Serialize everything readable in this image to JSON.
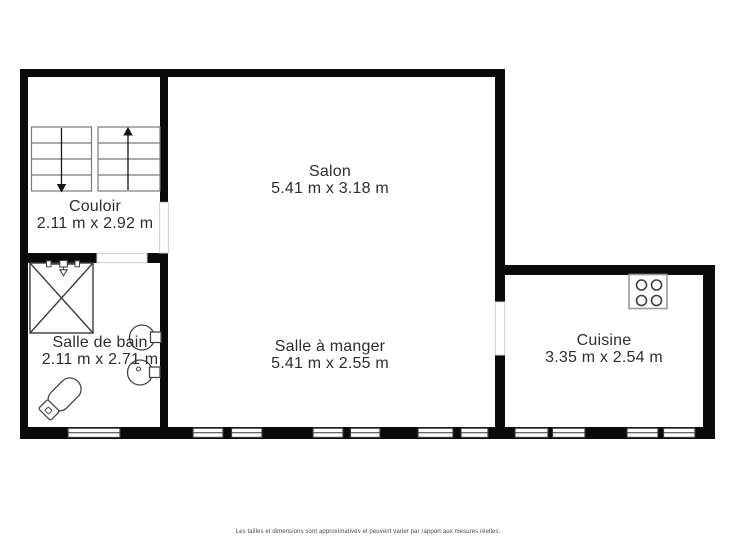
{
  "plan": {
    "title": "Floor plan",
    "rooms": [
      {
        "name": "Couloir",
        "dimensions": "2.11 m x 2.92 m"
      },
      {
        "name": "Salon",
        "dimensions": "5.41 m x 3.18 m"
      },
      {
        "name": "Salle de bain",
        "dimensions": "2.11 m x 2.71 m"
      },
      {
        "name": "Salle à manger",
        "dimensions": "5.41 m x 2.55 m"
      },
      {
        "name": "Cuisine",
        "dimensions": "3.35 m x 2.54 m"
      }
    ],
    "icons": {
      "stairs": "stairs-icon",
      "shower": "shower-icon",
      "toilet": "toilet-icon",
      "sink": "sink-icon",
      "stove": "stove-icon",
      "window": "window-symbol",
      "door": "door-opening"
    }
  },
  "footer": {
    "disclaimer": "Les tailles et dimensions sont approximatives et peuvent varier par rapport aux mesures réelles."
  },
  "colors": {
    "wall": "#0a0a0a",
    "fixture_stroke": "#464646",
    "label_text": "#2e2e2e",
    "footer_text": "#4a4a4a",
    "background": "#ffffff"
  }
}
